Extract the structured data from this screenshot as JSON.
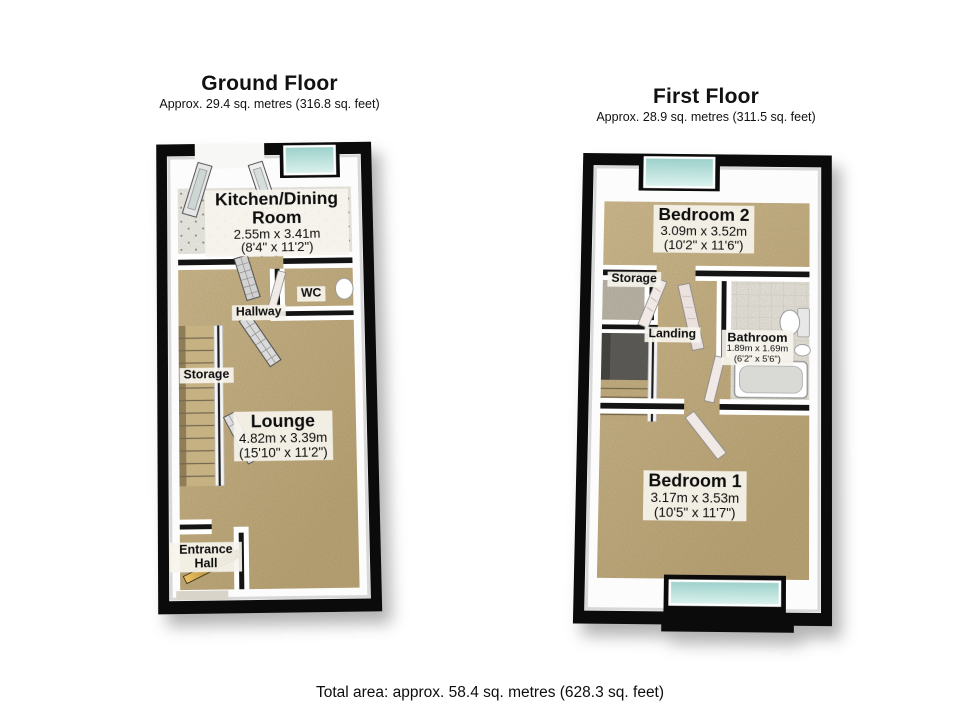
{
  "ground_floor": {
    "title": "Ground Floor",
    "subtitle": "Approx. 29.4 sq. metres (316.8 sq. feet)",
    "rooms": {
      "kitchen": {
        "name": "Kitchen/Dining Room",
        "metric": "2.55m x 3.41m",
        "imperial": "(8'4\" x 11'2\")"
      },
      "wc": {
        "name": "WC"
      },
      "hallway": {
        "name": "Hallway"
      },
      "storage": {
        "name": "Storage"
      },
      "lounge": {
        "name": "Lounge",
        "metric": "4.82m x 3.39m",
        "imperial": "(15'10\" x 11'2\")"
      },
      "entrance_hall": {
        "name": "Entrance Hall"
      }
    }
  },
  "first_floor": {
    "title": "First Floor",
    "subtitle": "Approx. 28.9 sq. metres (311.5 sq. feet)",
    "rooms": {
      "bedroom2": {
        "name": "Bedroom 2",
        "metric": "3.09m x 3.52m",
        "imperial": "(10'2\" x 11'6\")"
      },
      "storage": {
        "name": "Storage"
      },
      "landing": {
        "name": "Landing"
      },
      "bathroom": {
        "name": "Bathroom",
        "metric": "1.89m x 1.69m",
        "imperial": "(6'2\" x 5'6\")"
      },
      "bedroom1": {
        "name": "Bedroom 1",
        "metric": "3.17m x 3.53m",
        "imperial": "(10'5\" x 11'7\")"
      }
    }
  },
  "footer": {
    "total_area": "Total area: approx. 58.4 sq. metres (628.3 sq. feet)"
  },
  "colors": {
    "wall": "#0b0b0b",
    "wall_face": "#fcfcfc",
    "carpet": "#c9b586",
    "kitchen_tile": "#f3f3ef",
    "bathroom_tile": "#eceae4",
    "window_glass": "#bfe2de",
    "stairwell_dark": "#585858",
    "front_door_wood": "#c89b3c",
    "label_background": "#f6f4ed"
  }
}
